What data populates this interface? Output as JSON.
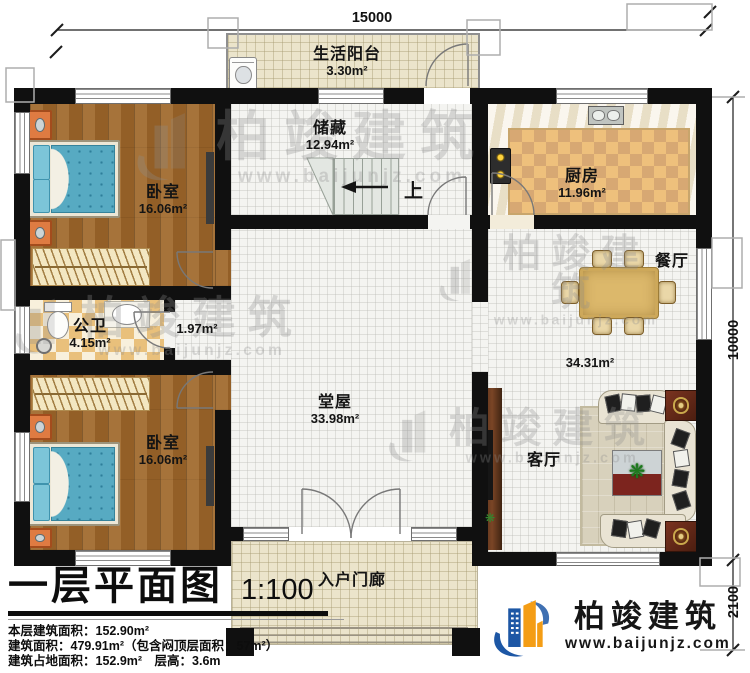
{
  "plan": {
    "stairs_up_label": "上",
    "dimensions": {
      "top_width": "15000",
      "right_height": "10000",
      "porch_depth": "2100"
    },
    "rooms": {
      "balcony": {
        "name": "生活阳台",
        "area": "3.30m²"
      },
      "storage": {
        "name": "储藏",
        "area": "12.94m²"
      },
      "kitchen": {
        "name": "厨房",
        "area": "11.96m²"
      },
      "bedroom_top": {
        "name": "卧室",
        "area": "16.06m²"
      },
      "bathroom": {
        "name": "公卫",
        "area": "4.15m²"
      },
      "hallway": {
        "area": "1.97m²"
      },
      "bedroom_bottom": {
        "name": "卧室",
        "area": "16.06m²"
      },
      "hall": {
        "name": "堂屋",
        "area": "33.98m²"
      },
      "dining": {
        "name": "餐厅"
      },
      "dining_living": {
        "area": "34.31m²"
      },
      "living": {
        "name": "客厅"
      },
      "porch": {
        "name": "入户门廊"
      }
    }
  },
  "title_block": {
    "title": "一层平面图",
    "scale": "1:100",
    "stats": [
      "本层建筑面积：152.90m²",
      "建筑面积：479.91m²（包含闷顶层面积：57m²）",
      "建筑占地面积：152.9m²　层高：3.6m"
    ]
  },
  "branding": {
    "company": "柏竣建筑",
    "website": "www.baijunjz.com"
  },
  "watermark": {
    "text": "柏竣建筑",
    "website": "www.baijunjz.com"
  },
  "colors": {
    "wall": "#101010",
    "wood_floor": "#9c662b",
    "tile_cream": "#ebe4cb",
    "checker_tan": "#e9c07b",
    "bed_blue": "#57aac2",
    "logo_blue": "#1d57a5",
    "logo_orange": "#f49d15"
  }
}
